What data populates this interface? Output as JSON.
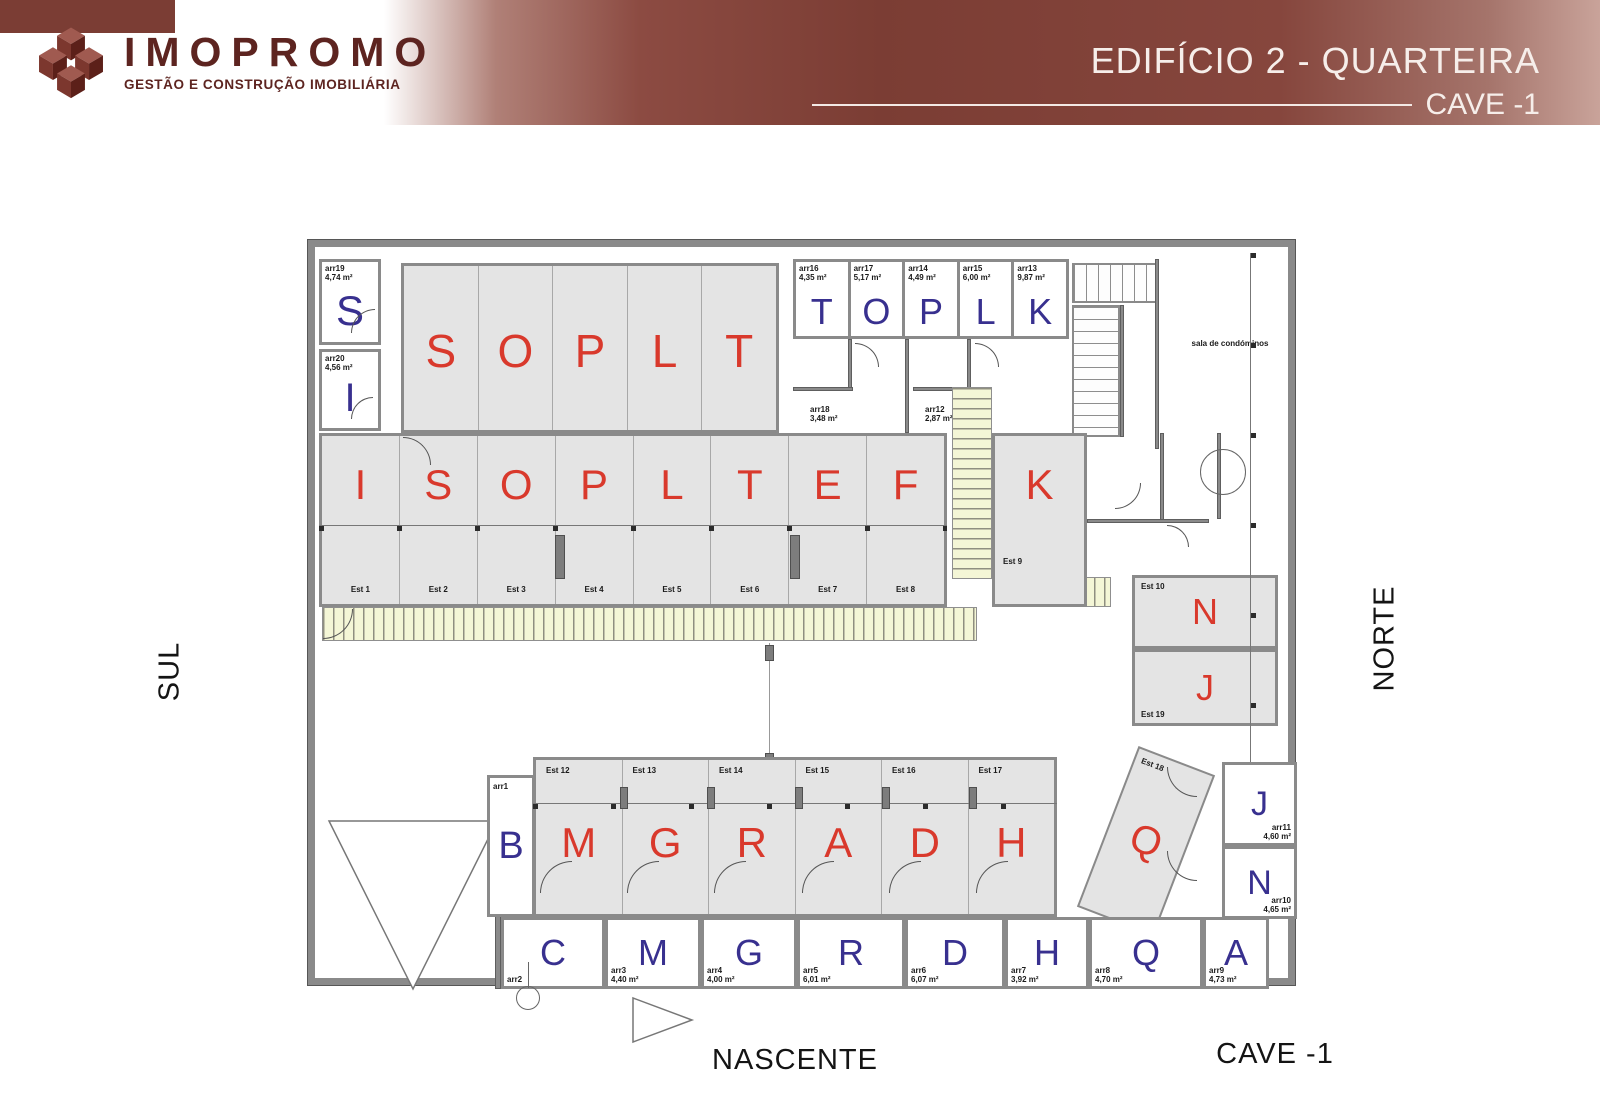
{
  "header": {
    "logo_name": "IMOPROMO",
    "logo_tagline": "GESTÃO E CONSTRUÇÃO IMOBILIÁRIA",
    "title": "EDIFÍCIO 2 - QUARTEIRA",
    "subtitle": "CAVE -1"
  },
  "orientation": {
    "left": "SUL",
    "right": "NORTE",
    "bottom": "NASCENTE"
  },
  "footer": {
    "floor": "CAVE -1"
  },
  "colors": {
    "banner": "#8a4a41",
    "parking_fill": "#e4e4e4",
    "letter_red": "#d9392c",
    "letter_blue": "#38308f",
    "hatch_fill": "#f4f6d6"
  },
  "plan": {
    "condo_room": "sala de condóminos",
    "top_left_rooms": [
      {
        "letter": "S",
        "ref": "arr19",
        "area": "4,74 m²"
      },
      {
        "letter": "I",
        "ref": "arr20",
        "area": "4,56 m²"
      }
    ],
    "top_row": [
      {
        "letter": "S"
      },
      {
        "letter": "O"
      },
      {
        "letter": "P"
      },
      {
        "letter": "L"
      },
      {
        "letter": "T"
      }
    ],
    "top_right_rooms": [
      {
        "letter": "T",
        "ref": "arr16",
        "area": "4,35 m²"
      },
      {
        "letter": "O",
        "ref": "arr17",
        "area": "5,17 m²"
      },
      {
        "letter": "P",
        "ref": "arr14",
        "area": "4,49 m²"
      },
      {
        "letter": "L",
        "ref": "arr15",
        "area": "6,00 m²"
      },
      {
        "letter": "K",
        "ref": "arr13",
        "area": "9,87 m²"
      }
    ],
    "mid_rooms": [
      {
        "ref": "arr18",
        "area": "3,48 m²"
      },
      {
        "ref": "arr12",
        "area": "2,87 m²"
      }
    ],
    "middle_row": [
      {
        "letter": "I",
        "est": "Est 1"
      },
      {
        "letter": "S",
        "est": "Est 2"
      },
      {
        "letter": "O",
        "est": "Est 3"
      },
      {
        "letter": "P",
        "est": "Est 4"
      },
      {
        "letter": "L",
        "est": "Est 5"
      },
      {
        "letter": "T",
        "est": "Est 6"
      },
      {
        "letter": "E",
        "est": "Est 7"
      },
      {
        "letter": "F",
        "est": "Est 8"
      }
    ],
    "k_space": {
      "letter": "K",
      "est": "Est 9"
    },
    "n_space": {
      "letter": "N",
      "est": "Est 10"
    },
    "j_space": {
      "letter": "J",
      "est": "Est 19"
    },
    "q_space": {
      "letter": "Q",
      "est": "Est 18"
    },
    "bottom_row": [
      {
        "letter": "M",
        "est": "Est 12"
      },
      {
        "letter": "G",
        "est": "Est 13"
      },
      {
        "letter": "R",
        "est": "Est 14"
      },
      {
        "letter": "A",
        "est": "Est 15"
      },
      {
        "letter": "D",
        "est": "Est 16"
      },
      {
        "letter": "H",
        "est": "Est 17"
      }
    ],
    "b_room": {
      "letter": "B",
      "ref": "arr1"
    },
    "bottom_rooms": [
      {
        "letter": "C",
        "ref": "arr2",
        "area": ""
      },
      {
        "letter": "M",
        "ref": "arr3",
        "area": "4,40 m²"
      },
      {
        "letter": "G",
        "ref": "arr4",
        "area": "4,00 m²"
      },
      {
        "letter": "R",
        "ref": "arr5",
        "area": "6,01 m²"
      },
      {
        "letter": "D",
        "ref": "arr6",
        "area": "6,07 m²"
      },
      {
        "letter": "H",
        "ref": "arr7",
        "area": "3,92 m²"
      },
      {
        "letter": "Q",
        "ref": "arr8",
        "area": "4,70 m²"
      },
      {
        "letter": "A",
        "ref": "arr9",
        "area": "4,73 m²"
      }
    ],
    "right_rooms": [
      {
        "letter": "J",
        "ref": "arr11",
        "area": "4,60 m²"
      },
      {
        "letter": "N",
        "ref": "arr10",
        "area": "4,65 m²"
      }
    ]
  }
}
